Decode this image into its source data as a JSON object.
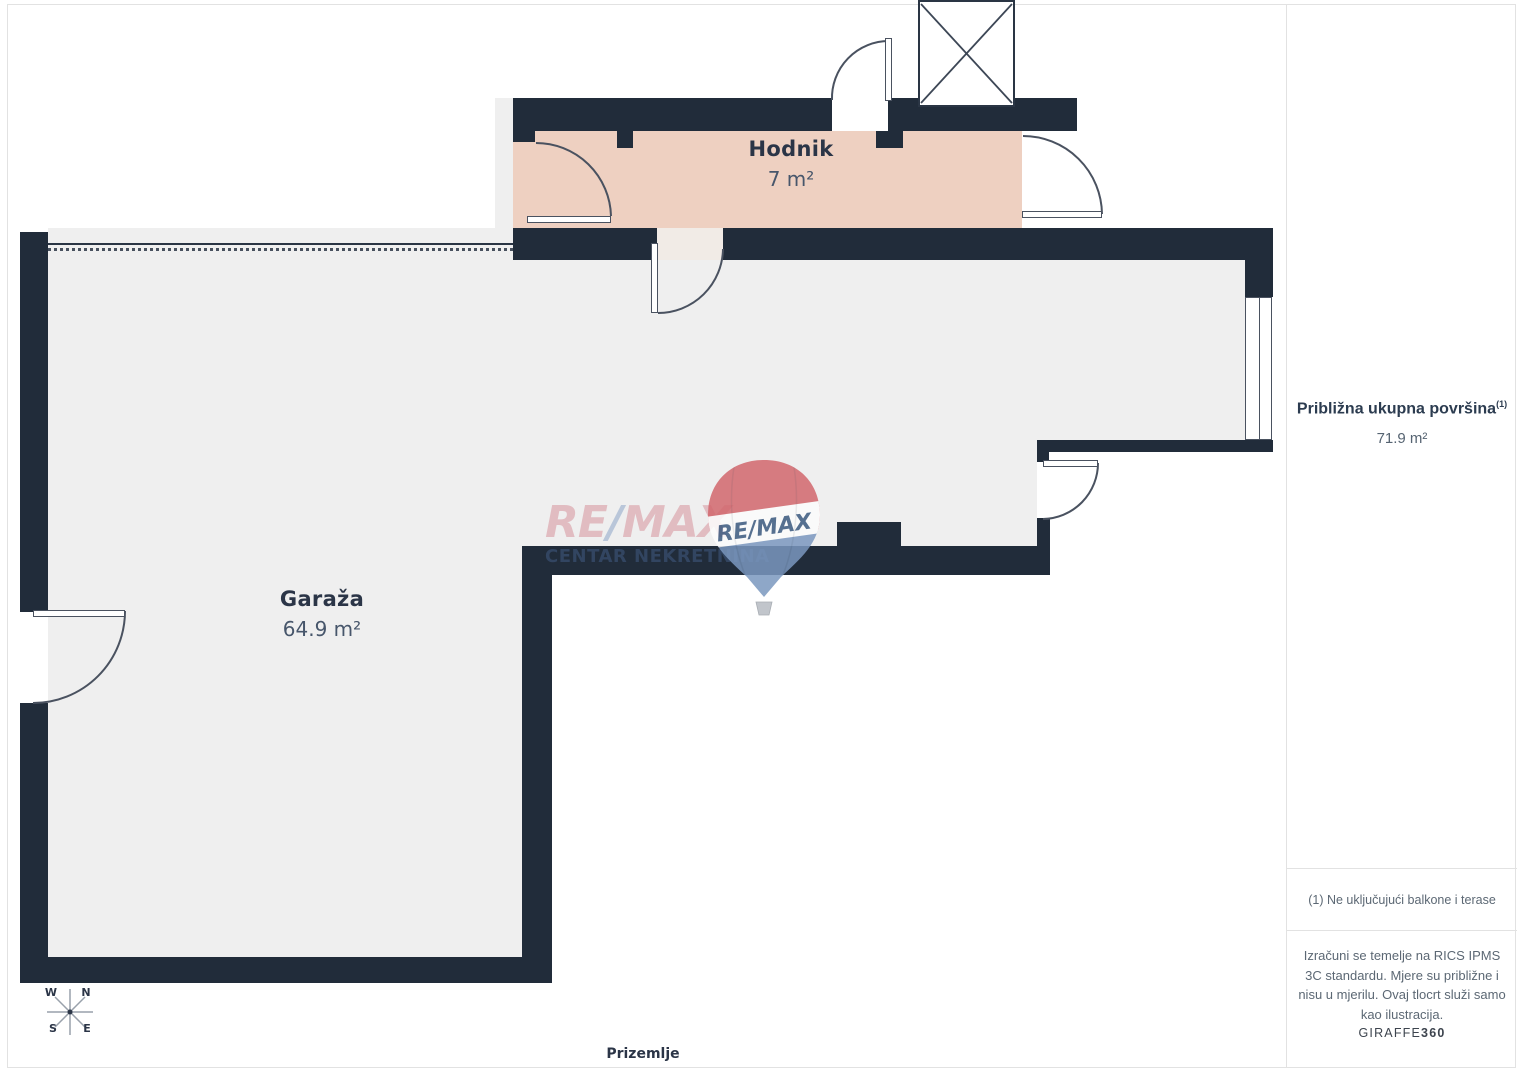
{
  "plan": {
    "rooms": [
      {
        "name": "Hodnik",
        "area": "7 m²"
      },
      {
        "name": "Garaža",
        "area": "64.9 m²"
      }
    ],
    "floor_label": "Prizemlje",
    "compass": {
      "n": "N",
      "e": "E",
      "s": "S",
      "w": "W"
    }
  },
  "watermark": {
    "brand_re": "RE",
    "brand_slash": "/",
    "brand_max": "MAX",
    "subtitle": "CENTAR NEKRETNINA"
  },
  "balloon": {
    "brand": "RE/MAX"
  },
  "sidebar": {
    "total_area_label": "Približna ukupna površina",
    "total_area_sup": "(1)",
    "total_area_value": "71.9 m²",
    "note": "(1) Ne uključujući balkone i terase",
    "disclaimer": "Izračuni se temelje na RICS IPMS 3C standardu. Mjere su približne i nisu u mjerilu. Ovaj tlocrt služi samo kao ilustracija.",
    "brand": "GIRAFFE",
    "brand_suffix": "360"
  },
  "colors": {
    "wall": "#212c3a",
    "garage_floor": "#efefef",
    "corridor_floor": "#eed0c1",
    "remax_red": "#d2676d",
    "remax_blue": "#7b98bf"
  }
}
